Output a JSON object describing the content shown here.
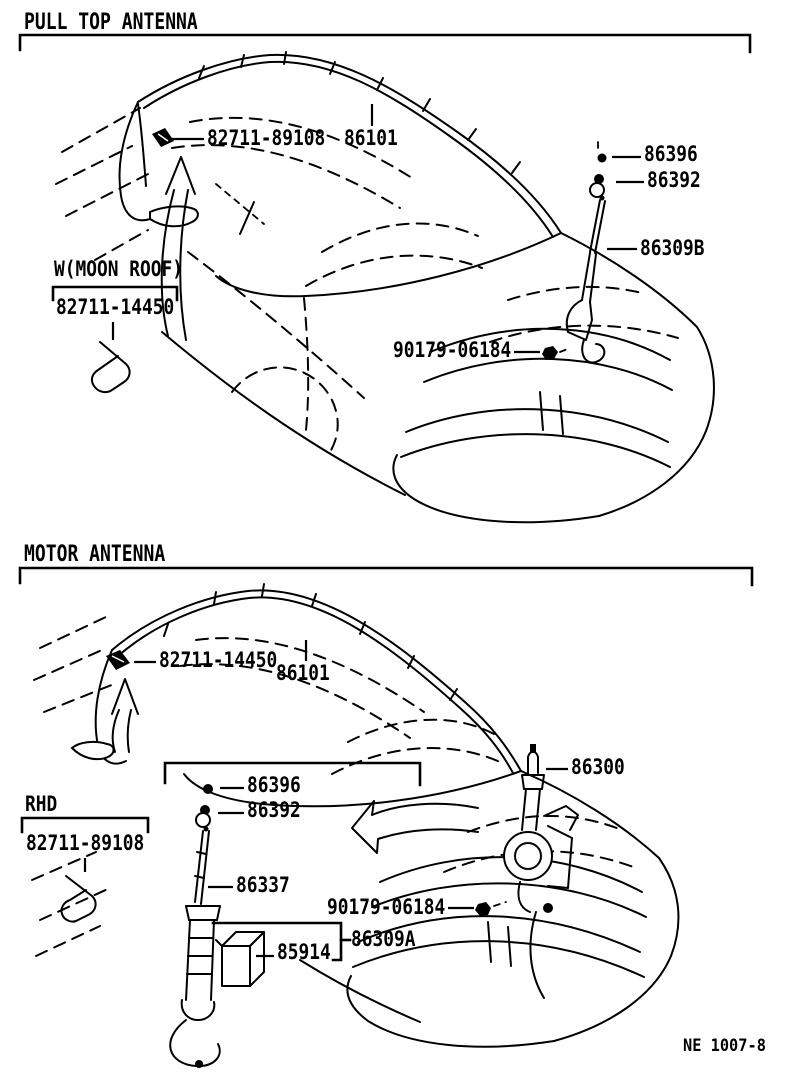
{
  "page": {
    "background": "#ffffff",
    "line_color": "#000000"
  },
  "sections": [
    {
      "title": "PULL TOP ANTENNA",
      "labels": [
        "82711-89108",
        "86101",
        "86396",
        "86392",
        "86309B",
        "W(MOON ROOF)",
        "82711-14450",
        "90179-06184"
      ]
    },
    {
      "title": "MOTOR ANTENNA",
      "labels": [
        "82711-14450",
        "86101",
        "86300",
        "86396",
        "86392",
        "RHD",
        "82711-89108",
        "86337",
        "90179-06184",
        "86309A",
        "85914"
      ]
    }
  ],
  "footer": {
    "code": "NE 1007-8"
  },
  "icons": [
    "antenna-cord-clip-icon",
    "nut-icon",
    "grommet-icon",
    "antenna-mast-icon",
    "mounting-bolt-icon",
    "moonroof-clip-icon",
    "rhd-clip-icon",
    "motor-antenna-assembly-icon",
    "relay-box-icon",
    "curved-up-arrow-icon",
    "curved-left-arrow-icon"
  ]
}
